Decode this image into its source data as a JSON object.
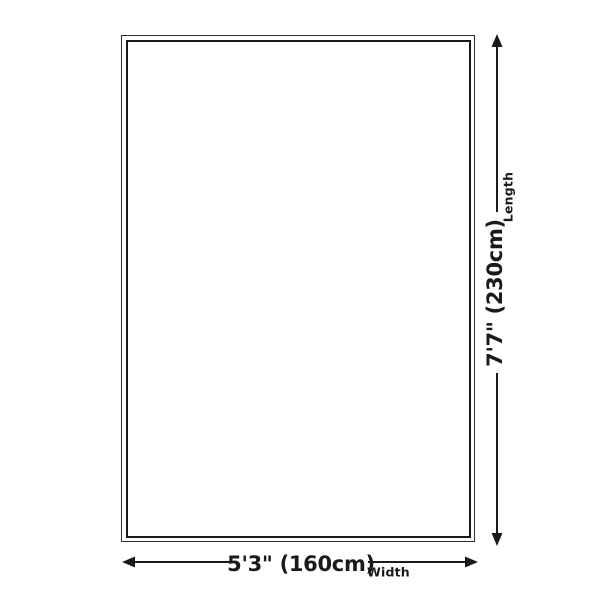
{
  "diagram": {
    "title": "Product dimension diagram",
    "dimensions": {
      "width": {
        "value": "5'3\" (160cm)",
        "label": "Width"
      },
      "length": {
        "value": "7'7\" (230cm)",
        "label": "Length"
      }
    },
    "icons": {
      "width_arrow_left": "arrow-left",
      "width_arrow_right": "arrow-right",
      "length_arrow_up": "arrow-up",
      "length_arrow_down": "arrow-down"
    }
  },
  "colors": {
    "line": "#1a1a1a",
    "border": "#2e2e2e",
    "background": "#ffffff"
  }
}
